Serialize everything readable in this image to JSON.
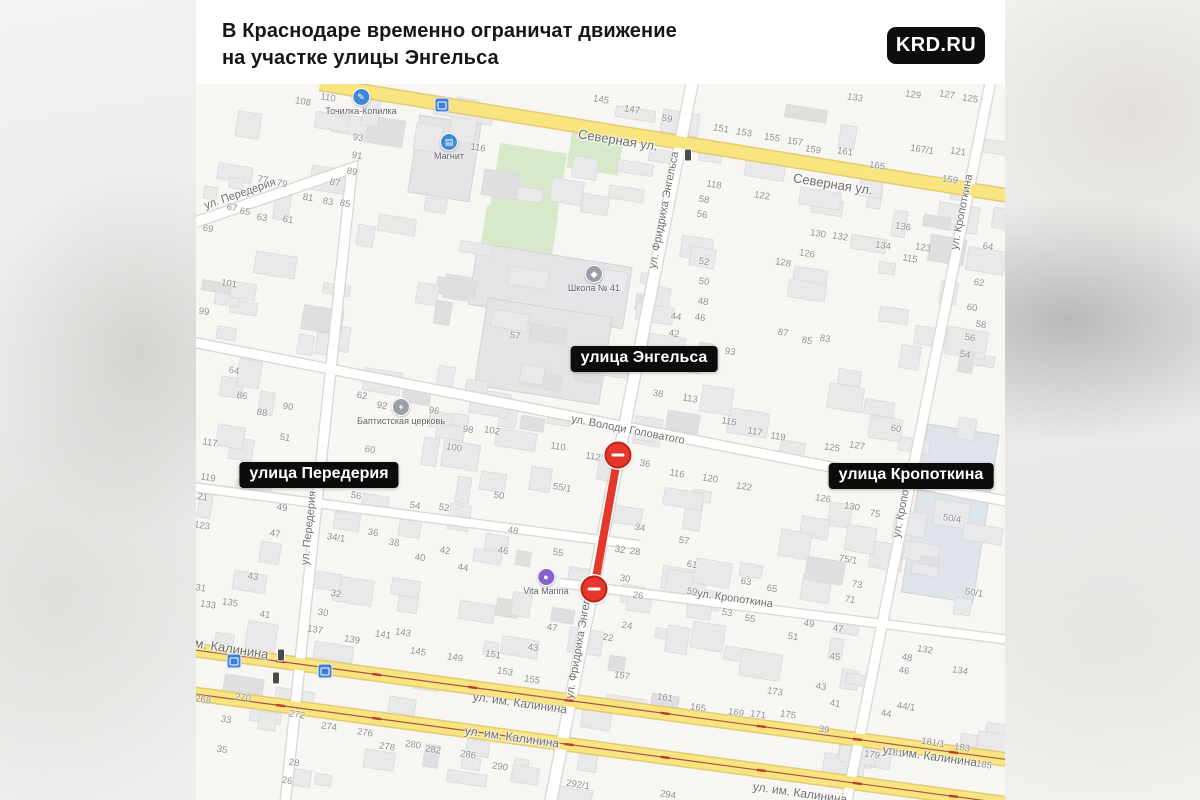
{
  "header": {
    "title_line1": "В Краснодаре временно ограничат движение",
    "title_line2": "на участке улицы Энгельса",
    "brand": "KRD.RU"
  },
  "map": {
    "callouts": [
      {
        "text": "улица Энгельса",
        "x": 644,
        "y": 359
      },
      {
        "text": "улица Передерия",
        "x": 319,
        "y": 475
      },
      {
        "text": "улица Кропоткина",
        "x": 911,
        "y": 476
      }
    ],
    "street_labels": [
      {
        "text": "Северная ул.",
        "x": 618,
        "y": 140,
        "rot": 9,
        "size": 13
      },
      {
        "text": "Северная ул.",
        "x": 833,
        "y": 184,
        "rot": 9,
        "size": 13
      },
      {
        "text": "ул. Володи Головатого",
        "x": 628,
        "y": 430,
        "rot": 11,
        "size": 11
      },
      {
        "text": "ул. Кропоткина",
        "x": 735,
        "y": 599,
        "rot": 8,
        "size": 11
      },
      {
        "text": "ул. им. Калинина",
        "x": 520,
        "y": 703,
        "rot": 8,
        "size": 12
      },
      {
        "text": "ул. им. Калинина",
        "x": 512,
        "y": 737,
        "rot": 8,
        "size": 12
      },
      {
        "text": "ул. им. Калинина",
        "x": 930,
        "y": 756,
        "rot": 8,
        "size": 12
      },
      {
        "text": "ул. им. Калинина",
        "x": 800,
        "y": 793,
        "rot": 8,
        "size": 12
      },
      {
        "text": "им. Калинина",
        "x": 228,
        "y": 648,
        "rot": 9,
        "size": 13
      },
      {
        "text": "ул. Передерия",
        "x": 240,
        "y": 194,
        "rot": -19,
        "size": 11
      },
      {
        "text": "ул. Передерия",
        "x": 309,
        "y": 528,
        "rot": -84,
        "size": 11
      },
      {
        "text": "ул. Фридриха Энгельса",
        "x": 664,
        "y": 210,
        "rot": -79,
        "size": 11
      },
      {
        "text": "ул. Фридриха Энгельса",
        "x": 580,
        "y": 640,
        "rot": -80,
        "size": 11
      },
      {
        "text": "ул. Кропоткина",
        "x": 962,
        "y": 212,
        "rot": -79,
        "size": 11
      },
      {
        "text": "ул. Кропоткина",
        "x": 904,
        "y": 500,
        "rot": -79,
        "size": 11
      }
    ],
    "pois": [
      {
        "name": "Точилка-Копилка",
        "x": 361,
        "y": 96,
        "color": "#3f87d9",
        "glyph": "✎"
      },
      {
        "name": "Магнит",
        "x": 449,
        "y": 141,
        "color": "#3f87d9",
        "glyph": "▤"
      },
      {
        "name": "Школа № 41",
        "x": 594,
        "y": 273,
        "color": "#9a9ea6",
        "glyph": "◆"
      },
      {
        "name": "Баптистская церковь",
        "x": 401,
        "y": 406,
        "color": "#9a9ea6",
        "glyph": "+"
      },
      {
        "name": "Vita Marina",
        "x": 546,
        "y": 576,
        "color": "#8860d0",
        "glyph": "●"
      }
    ],
    "transit_stops": [
      {
        "x": 442,
        "y": 105
      },
      {
        "x": 234,
        "y": 661
      },
      {
        "x": 325,
        "y": 671
      }
    ],
    "traffic_lights": [
      {
        "x": 688,
        "y": 155
      },
      {
        "x": 281,
        "y": 655
      },
      {
        "x": 276,
        "y": 678
      }
    ],
    "closure": {
      "x1": 618,
      "y1": 455,
      "x2": 594,
      "y2": 589
    },
    "house_numbers": [
      [
        "108",
        303,
        102
      ],
      [
        "110",
        328,
        98
      ],
      [
        "116",
        478,
        148
      ],
      [
        "93",
        358,
        138
      ],
      [
        "91",
        357,
        156
      ],
      [
        "89",
        352,
        172
      ],
      [
        "87",
        335,
        183
      ],
      [
        "77",
        263,
        180
      ],
      [
        "79",
        282,
        184
      ],
      [
        "81",
        308,
        198
      ],
      [
        "83",
        328,
        202
      ],
      [
        "85",
        345,
        204
      ],
      [
        "67",
        232,
        208
      ],
      [
        "65",
        245,
        212
      ],
      [
        "63",
        262,
        218
      ],
      [
        "61",
        288,
        220
      ],
      [
        "69",
        208,
        229
      ],
      [
        "101",
        229,
        284
      ],
      [
        "99",
        204,
        312
      ],
      [
        "64",
        234,
        371
      ],
      [
        "86",
        242,
        396
      ],
      [
        "88",
        262,
        413
      ],
      [
        "90",
        288,
        407
      ],
      [
        "51",
        285,
        438
      ],
      [
        "117",
        210,
        443
      ],
      [
        "119",
        208,
        478
      ],
      [
        "121",
        200,
        497
      ],
      [
        "123",
        202,
        526
      ],
      [
        "49",
        282,
        508
      ],
      [
        "47",
        275,
        534
      ],
      [
        "43",
        253,
        577
      ],
      [
        "62",
        362,
        396
      ],
      [
        "92",
        382,
        406
      ],
      [
        "96",
        434,
        411
      ],
      [
        "98",
        468,
        430
      ],
      [
        "102",
        492,
        431
      ],
      [
        "100",
        454,
        448
      ],
      [
        "60",
        370,
        450
      ],
      [
        "56",
        356,
        496
      ],
      [
        "54",
        415,
        506
      ],
      [
        "52",
        444,
        508
      ],
      [
        "50",
        499,
        496
      ],
      [
        "48",
        513,
        531
      ],
      [
        "46",
        503,
        551
      ],
      [
        "44",
        463,
        568
      ],
      [
        "42",
        445,
        551
      ],
      [
        "40",
        420,
        558
      ],
      [
        "38",
        394,
        543
      ],
      [
        "36",
        373,
        533
      ],
      [
        "34/1",
        336,
        538
      ],
      [
        "32",
        336,
        594
      ],
      [
        "55",
        558,
        553
      ],
      [
        "55/1",
        562,
        488
      ],
      [
        "57",
        515,
        336
      ],
      [
        "145",
        601,
        100
      ],
      [
        "147",
        632,
        110
      ],
      [
        "59",
        667,
        119
      ],
      [
        "151",
        721,
        129
      ],
      [
        "153",
        744,
        133
      ],
      [
        "155",
        772,
        138
      ],
      [
        "157",
        795,
        142
      ],
      [
        "159",
        813,
        150
      ],
      [
        "161",
        845,
        152
      ],
      [
        "165",
        877,
        166
      ],
      [
        "167/1",
        922,
        150
      ],
      [
        "121",
        958,
        152
      ],
      [
        "159",
        950,
        180
      ],
      [
        "133",
        855,
        98
      ],
      [
        "129",
        913,
        95
      ],
      [
        "127",
        947,
        95
      ],
      [
        "125",
        970,
        99
      ],
      [
        "118",
        714,
        185
      ],
      [
        "122",
        762,
        196
      ],
      [
        "58",
        704,
        200
      ],
      [
        "130",
        818,
        234
      ],
      [
        "132",
        840,
        237
      ],
      [
        "136",
        903,
        227
      ],
      [
        "134",
        883,
        246
      ],
      [
        "123",
        923,
        248
      ],
      [
        "115",
        910,
        259
      ],
      [
        "126",
        807,
        254
      ],
      [
        "128",
        783,
        263
      ],
      [
        "64",
        988,
        247
      ],
      [
        "62",
        979,
        283
      ],
      [
        "60",
        972,
        308
      ],
      [
        "58",
        981,
        325
      ],
      [
        "56",
        970,
        338
      ],
      [
        "54",
        965,
        355
      ],
      [
        "56",
        702,
        215
      ],
      [
        "52",
        704,
        262
      ],
      [
        "50",
        704,
        282
      ],
      [
        "48",
        703,
        302
      ],
      [
        "46",
        700,
        318
      ],
      [
        "44",
        676,
        317
      ],
      [
        "42",
        674,
        334
      ],
      [
        "93",
        730,
        352
      ],
      [
        "87",
        783,
        333
      ],
      [
        "85",
        807,
        341
      ],
      [
        "83",
        825,
        339
      ],
      [
        "38",
        658,
        394
      ],
      [
        "113",
        690,
        399
      ],
      [
        "115",
        729,
        422
      ],
      [
        "117",
        755,
        432
      ],
      [
        "119",
        778,
        437
      ],
      [
        "125",
        832,
        448
      ],
      [
        "127",
        857,
        446
      ],
      [
        "60",
        896,
        429
      ],
      [
        "110",
        558,
        447
      ],
      [
        "112",
        593,
        457
      ],
      [
        "36",
        645,
        464
      ],
      [
        "116",
        677,
        474
      ],
      [
        "120",
        710,
        479
      ],
      [
        "122",
        744,
        487
      ],
      [
        "50/4",
        952,
        519
      ],
      [
        "50/1",
        974,
        593
      ],
      [
        "126",
        823,
        499
      ],
      [
        "130",
        852,
        507
      ],
      [
        "75",
        875,
        514
      ],
      [
        "75/1",
        848,
        560
      ],
      [
        "73",
        857,
        585
      ],
      [
        "71",
        850,
        600
      ],
      [
        "34",
        640,
        528
      ],
      [
        "57",
        684,
        541
      ],
      [
        "32",
        620,
        550
      ],
      [
        "28",
        635,
        552
      ],
      [
        "61",
        692,
        565
      ],
      [
        "30",
        625,
        579
      ],
      [
        "63",
        746,
        582
      ],
      [
        "59",
        692,
        592
      ],
      [
        "26",
        638,
        596
      ],
      [
        "65",
        772,
        589
      ],
      [
        "53",
        727,
        613
      ],
      [
        "55",
        750,
        619
      ],
      [
        "49",
        809,
        624
      ],
      [
        "47",
        838,
        629
      ],
      [
        "51",
        793,
        637
      ],
      [
        "24",
        627,
        626
      ],
      [
        "22",
        608,
        638
      ],
      [
        "45",
        835,
        657
      ],
      [
        "43",
        821,
        687
      ],
      [
        "41",
        835,
        704
      ],
      [
        "39",
        824,
        730
      ],
      [
        "157",
        622,
        676
      ],
      [
        "161",
        665,
        698
      ],
      [
        "165",
        698,
        708
      ],
      [
        "169",
        736,
        713
      ],
      [
        "171",
        758,
        715
      ],
      [
        "173",
        775,
        692
      ],
      [
        "175",
        788,
        715
      ],
      [
        "132",
        925,
        650
      ],
      [
        "48",
        907,
        658
      ],
      [
        "46",
        904,
        671
      ],
      [
        "134",
        960,
        671
      ],
      [
        "44/1",
        906,
        707
      ],
      [
        "44",
        886,
        714
      ],
      [
        "181/1",
        933,
        743
      ],
      [
        "183",
        962,
        748
      ],
      [
        "181",
        895,
        753
      ],
      [
        "179",
        872,
        755
      ],
      [
        "185",
        984,
        765
      ],
      [
        "294",
        668,
        795
      ],
      [
        "292/1",
        578,
        785
      ],
      [
        "131",
        198,
        588
      ],
      [
        "133",
        208,
        605
      ],
      [
        "135",
        230,
        603
      ],
      [
        "41",
        265,
        615
      ],
      [
        "30",
        323,
        613
      ],
      [
        "137",
        315,
        630
      ],
      [
        "139",
        352,
        640
      ],
      [
        "141",
        383,
        635
      ],
      [
        "143",
        403,
        633
      ],
      [
        "145",
        418,
        652
      ],
      [
        "149",
        455,
        658
      ],
      [
        "151",
        493,
        655
      ],
      [
        "153",
        505,
        672
      ],
      [
        "155",
        532,
        680
      ],
      [
        "43",
        533,
        648
      ],
      [
        "47",
        552,
        628
      ],
      [
        "268",
        203,
        700
      ],
      [
        "270",
        243,
        698
      ],
      [
        "272",
        297,
        715
      ],
      [
        "274",
        329,
        727
      ],
      [
        "276",
        365,
        733
      ],
      [
        "278",
        387,
        747
      ],
      [
        "280",
        413,
        745
      ],
      [
        "282",
        433,
        750
      ],
      [
        "286",
        468,
        755
      ],
      [
        "290",
        500,
        767
      ],
      [
        "33",
        226,
        720
      ],
      [
        "35",
        222,
        750
      ],
      [
        "28",
        294,
        763
      ],
      [
        "26",
        287,
        781
      ]
    ],
    "colors": {
      "map_bg": "#f7f6f2",
      "building": "#e9e8ea",
      "building_dark": "#dfdee1",
      "building_stroke": "#d8d7da",
      "green": "#d8e9cb",
      "road_yellow": "#f9e57f",
      "road_yellow_casing": "#e2cb74",
      "road_white": "#ffffff",
      "road_casing": "#d9d7d3",
      "tram_line": "#a85545",
      "closure_red": "#e5372b"
    }
  }
}
